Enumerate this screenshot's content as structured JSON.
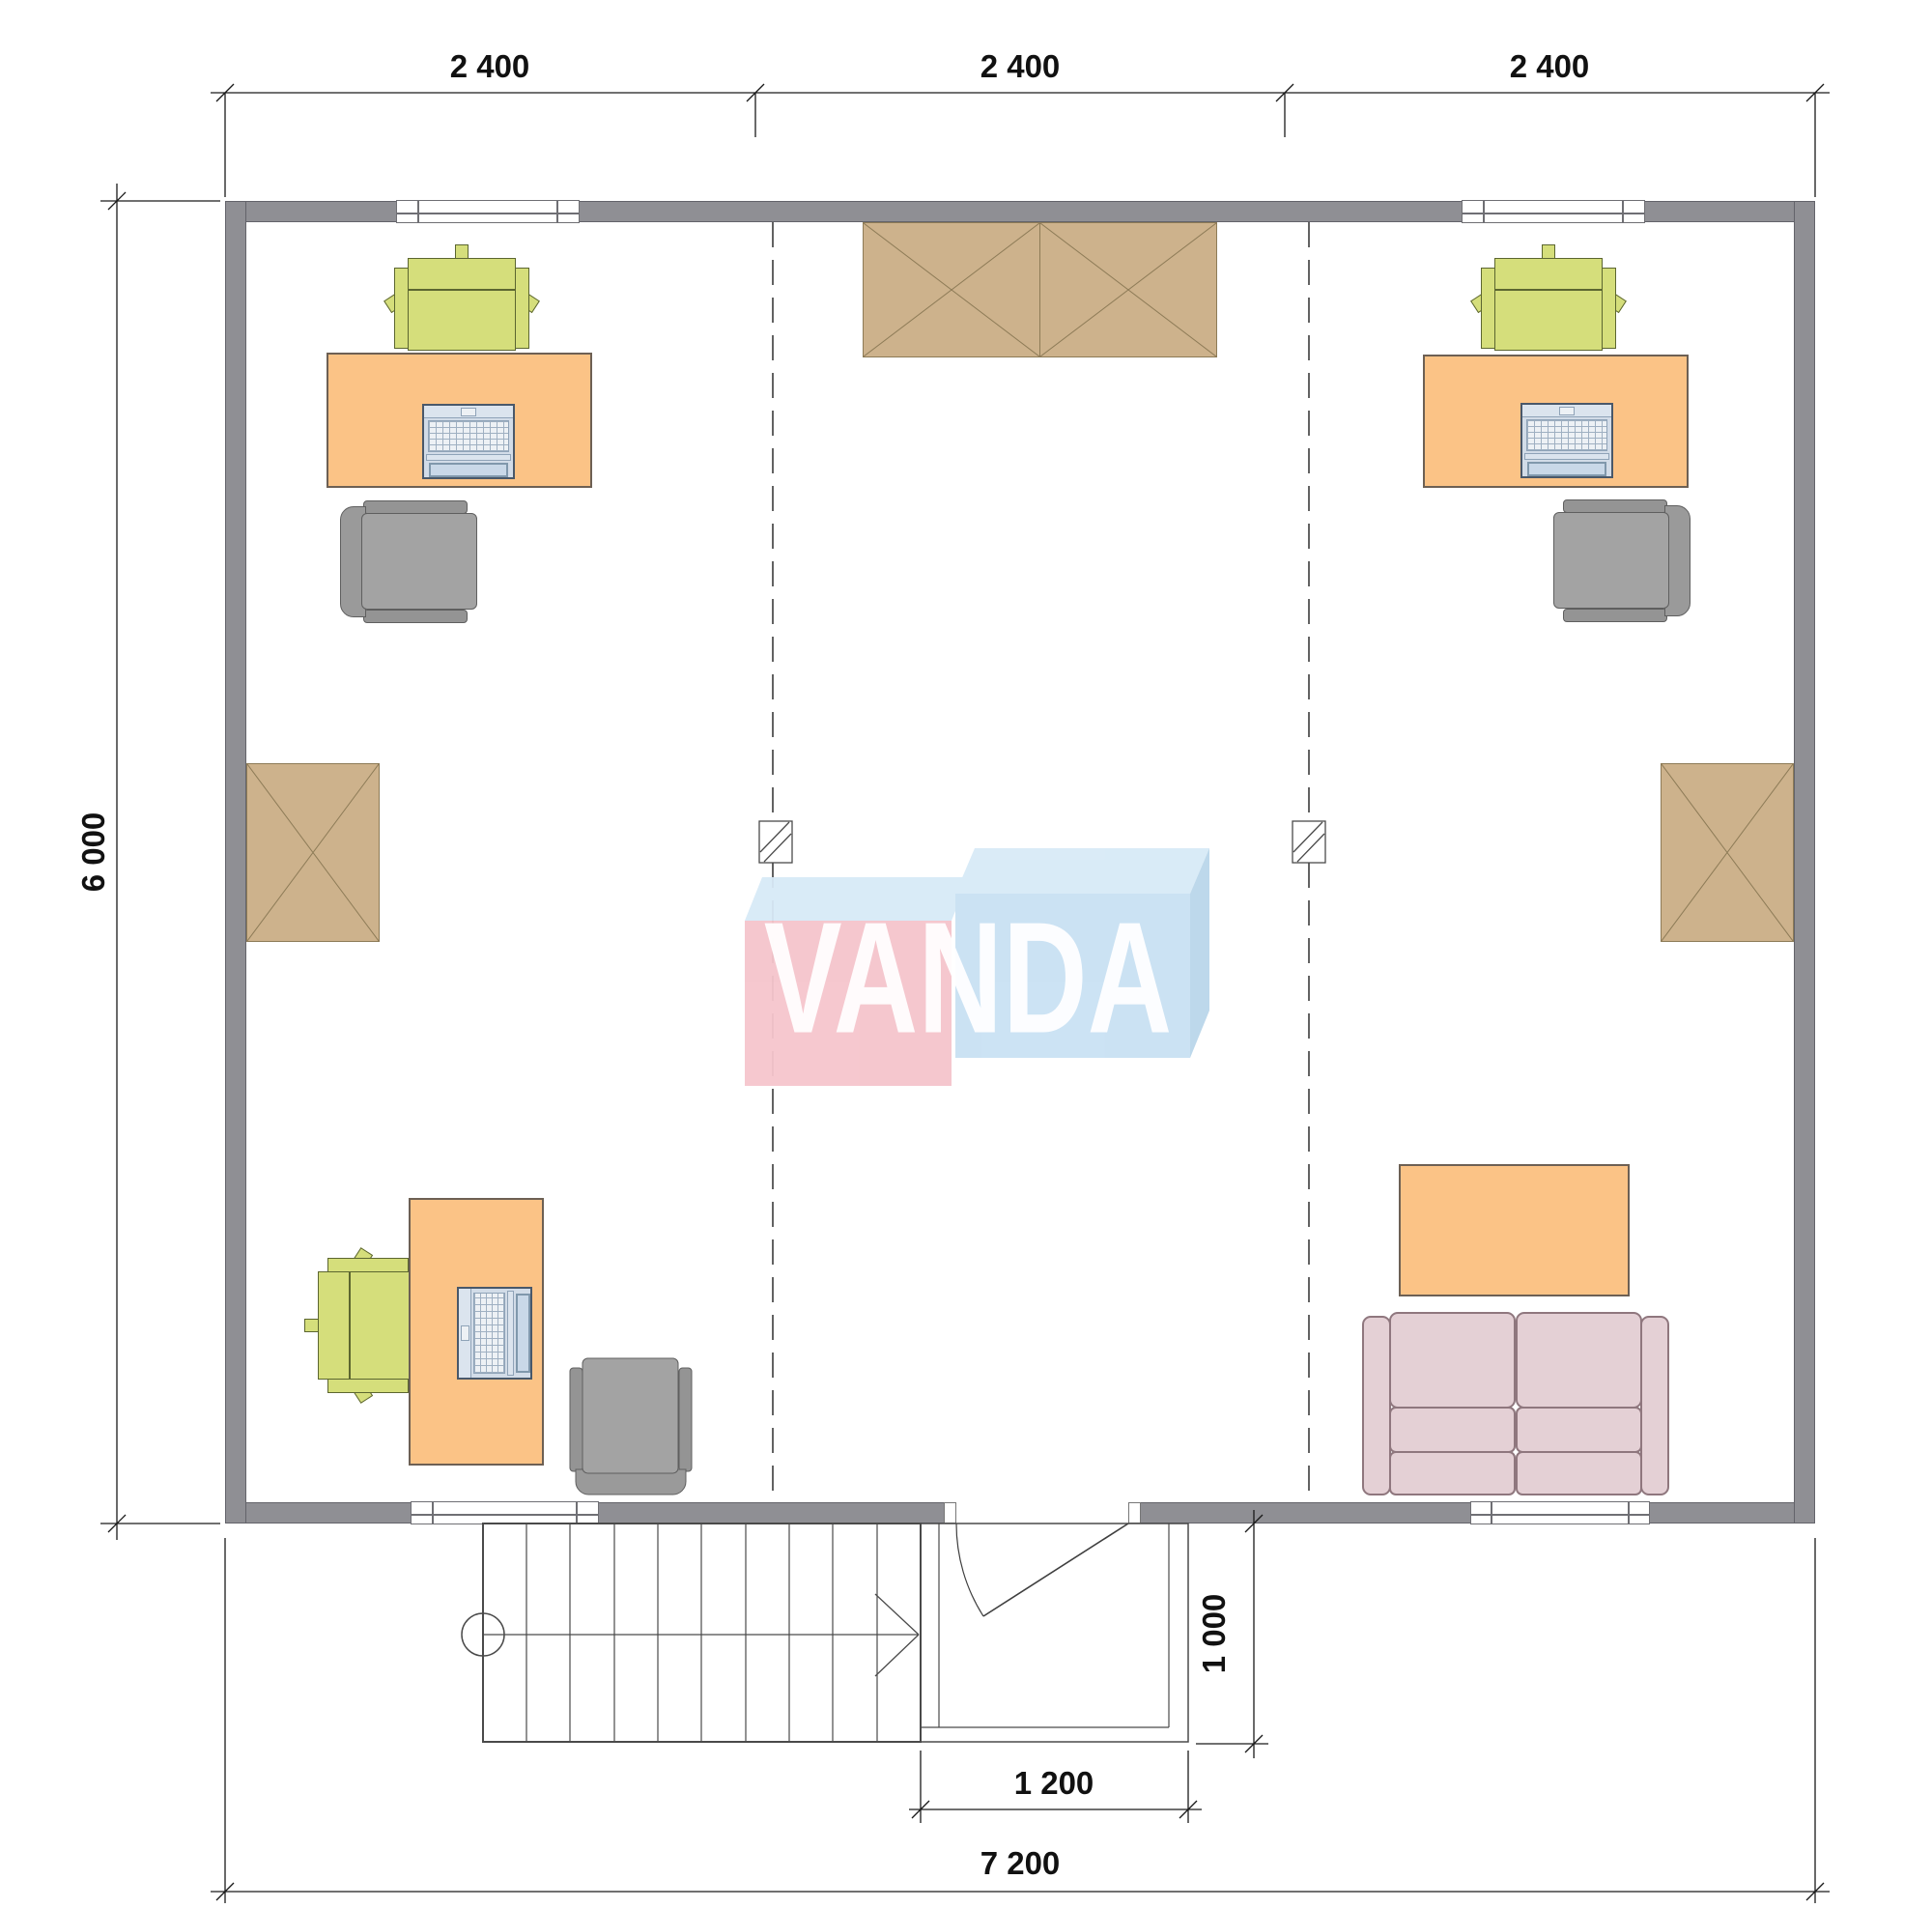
{
  "watermark": {
    "text": "VANDA",
    "left_box_color": "#F5C5CC",
    "right_box_color": "#C9E1F3",
    "top_face_color": "#D8EAF7",
    "text_color": "#FFFFFF"
  },
  "dimensions": {
    "top_modules": [
      "2 400",
      "2 400",
      "2 400"
    ],
    "left_total": "6 000",
    "bottom_total": "7 200",
    "entrance_width": "1 200",
    "porch_depth": "1 000"
  },
  "plan": {
    "furniture": [
      "desk",
      "task-chair",
      "office-chair",
      "laptop",
      "wardrobe",
      "coffee-table",
      "sofa"
    ],
    "features": [
      "stairs",
      "entrance-porch",
      "door",
      "windows",
      "grid-axis-columns"
    ]
  },
  "colors": {
    "wall": "#8F8F94",
    "desk": "#FBC386",
    "task_chair": "#D5DE7B",
    "office_chair": "#9A9A9A",
    "wardrobe": "#CDB28C",
    "sofa": "#E4D0D5",
    "laptop": "#D2DCE8",
    "dimension_text": "#111111"
  }
}
